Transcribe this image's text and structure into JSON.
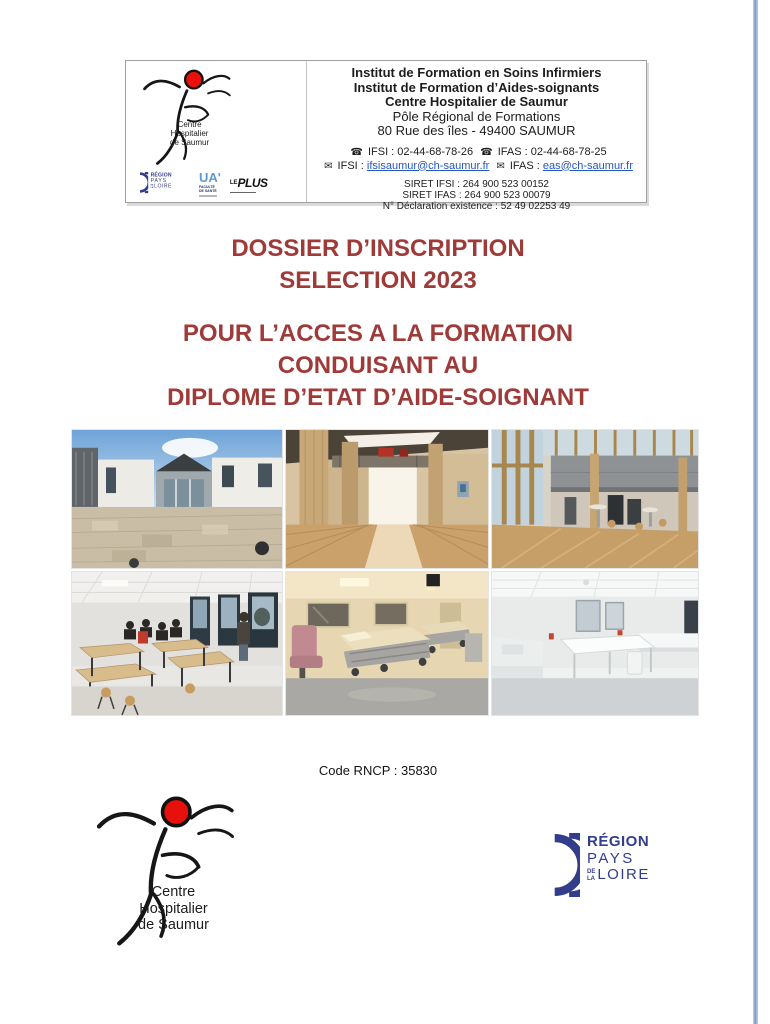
{
  "letterhead": {
    "bold_lines": [
      "Institut de Formation en Soins Infirmiers",
      "Institut de Formation d’Aides-soignants",
      "Centre Hospitalier de Saumur"
    ],
    "plain_lines": [
      "Pôle Régional de Formations",
      "80 Rue des îles - 49400 SAUMUR"
    ],
    "phone_icon": "☎",
    "email_icon": "✉",
    "phone_ifsi": "IFSI : 02-44-68-78-26",
    "phone_ifas": "IFAS : 02-44-68-78-25",
    "email_ifsi_label": "IFSI :",
    "email_ifsi": "ifsisaumur@ch-saumur.fr",
    "email_ifas_label": "IFAS :",
    "email_ifas": "eas@ch-saumur.fr",
    "siret_lines": [
      "SIRET IFSI : 264 900 523 00152",
      "SIRET IFAS : 264 900 523 00079",
      "N° Déclaration existence : 52 49 02253 49"
    ]
  },
  "ch_logo": {
    "caption": [
      "Centre",
      "Hospitalier",
      "de Saumur"
    ]
  },
  "partners": {
    "region": {
      "line1": "RÉGION",
      "line2": "PAYS",
      "de": "DE",
      "la": "LA",
      "loire": "LOIRE"
    },
    "ua": {
      "mark": "UA'",
      "sub1": "FACULTÉ",
      "sub2": "DE SANTÉ"
    },
    "leplus": {
      "le": "LE",
      "plus": "PLUS"
    }
  },
  "title": {
    "block1": [
      "DOSSIER D’INSCRIPTION",
      "SELECTION 2023"
    ],
    "block2": [
      "POUR L’ACCES A LA FORMATION",
      "CONDUISANT AU",
      "DIPLOME D’ETAT D’AIDE-SOIGNANT"
    ]
  },
  "photos": [
    "campus exterior courtyard",
    "wooden hallway interior",
    "atrium hall with tables",
    "classroom with students",
    "hospital simulation room with beds",
    "white practice room"
  ],
  "rncp_line": "Code RNCP : 35830",
  "colors": {
    "title_red": "#9e3a38",
    "region_navy": "#323e8c",
    "logo_red": "#e8100c",
    "link_blue": "#2456c5"
  }
}
